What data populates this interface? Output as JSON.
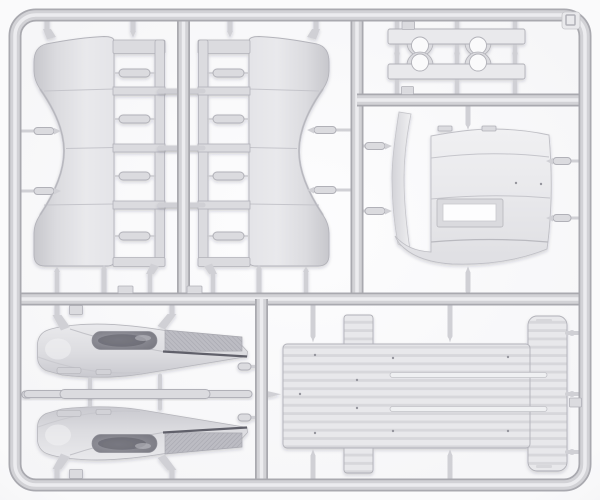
{
  "scene": {
    "kind": "product photograph",
    "subject": "Light-gray injection-molded plastic model kit sprue (parts tree) on a white background",
    "frame": "rounded rectangular runner frame with internal runner bars dividing five cells",
    "corner_tab": "small molded tab with embossed square outline, top-right corner"
  },
  "sprue": {
    "sections": [
      "top-left: two large curved side panels, each with a ladder frame holding four pill-shaped parts",
      "top-right: two clamp bars with twin semicircular cutouts facing each other",
      "middle-right: cab roof panel with rectangular hatch opening and curved visor strip",
      "bottom-left: two mirrored fender / running-board parts with a long thin rod between them",
      "bottom-right: large ribbed cargo platform panel with corner tabs and two slot ribs"
    ]
  },
  "parts": {
    "side_panel_left": {
      "label": "curved side panel with ladder frame and four pill parts (left)"
    },
    "side_panel_right": {
      "label": "curved side panel with ladder frame and four pill parts (right, mirrored)"
    },
    "clamp_bars": {
      "label": "two bars with twin semicircular cutouts"
    },
    "roof_panel": {
      "label": "cab roof panel with rectangular hatch opening and curved visor strip"
    },
    "fender_upper": {
      "label": "fender and running board with dark inset and tread plate (upper)"
    },
    "fender_lower": {
      "label": "fender and running board with dark inset and tread plate (lower, mirrored)"
    },
    "long_rod": {
      "label": "long thin rod part"
    },
    "cargo_platform": {
      "label": "large ribbed platform panel with tabs and slot ribs"
    },
    "corner_tab": {
      "label": "sprue corner tab with embossed square"
    }
  },
  "colors": {
    "bg_outer": "#e2e2e5",
    "bg_inner": "#fafafb",
    "runner_dark": "#a9a9af",
    "runner_mid": "#d2d2d6",
    "runner_light": "#ececef",
    "part_light": "#e9e9ec",
    "part_mid": "#dbdbdf",
    "part_shade": "#c7c7cc",
    "part_edge": "#b1b1b8",
    "gate": "#d0d0d5",
    "seam": "#c5c5cb",
    "dark_inset": "#73737c",
    "dark_inset_deep": "#5d5d66",
    "tread": "#bcbcc3",
    "tread_line": "#a6a6ae",
    "dark_line": "#60606a",
    "stripe_a": "#e8e8eb",
    "stripe_b": "#d7d7db",
    "dot": "#95959d",
    "hole_white": "#fdfdfe"
  }
}
